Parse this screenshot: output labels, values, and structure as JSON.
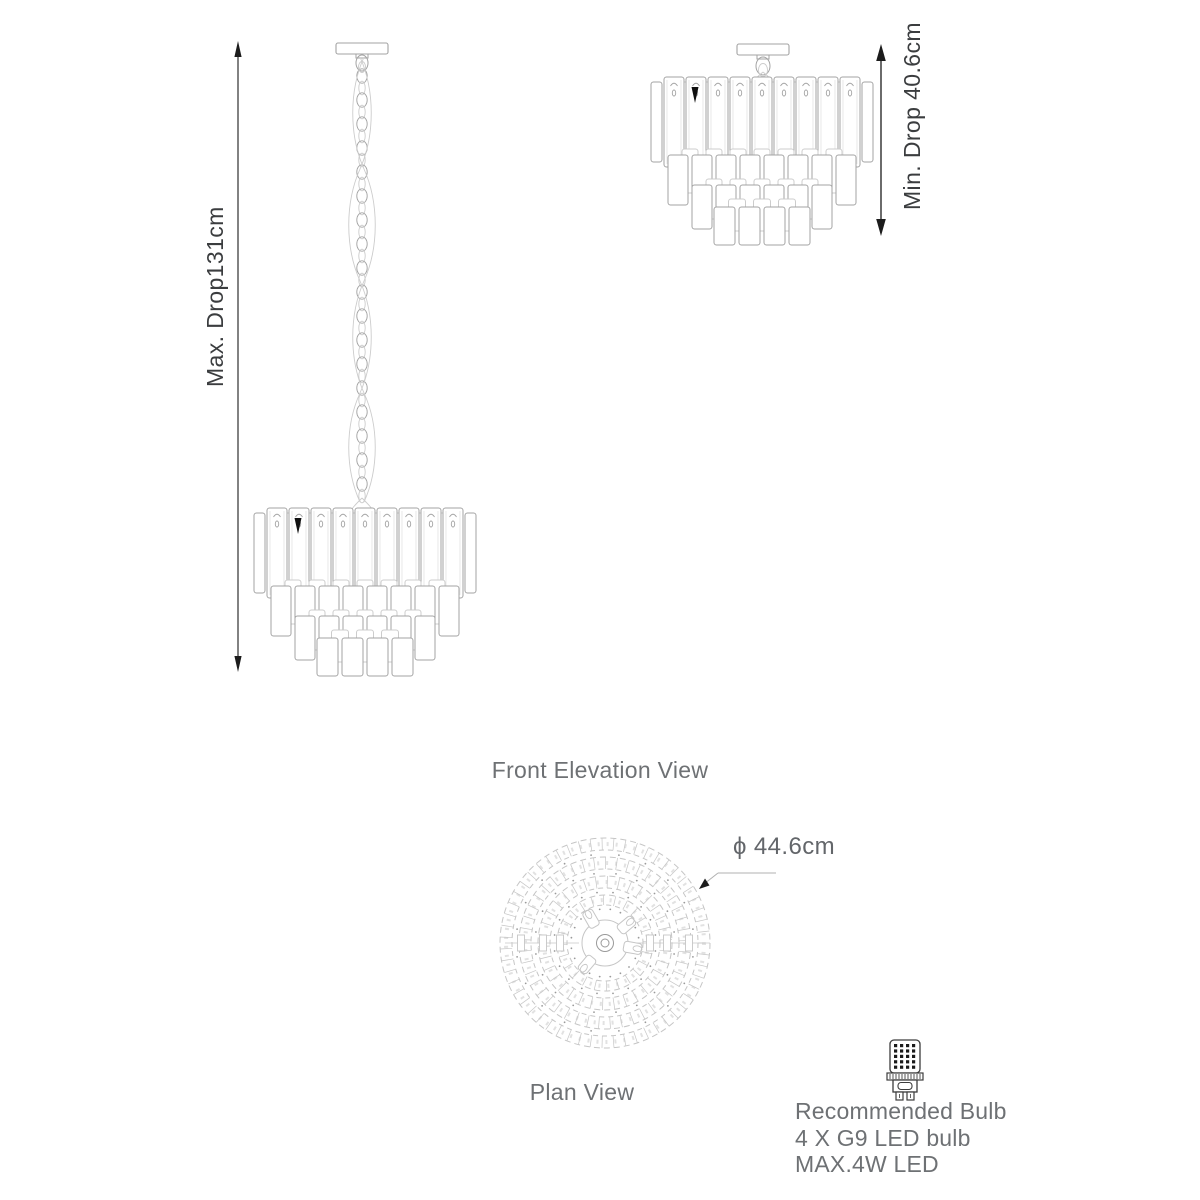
{
  "page": {
    "type": "product-dimension-diagram",
    "background": "#ffffff"
  },
  "colors": {
    "artwork_line": "#a3a3a3",
    "artwork_line_light": "#cccccc",
    "artwork_inner": "#e2e2e2",
    "plan_line": "#c6c6c6",
    "plan_dot": "#9a9a9a",
    "dimension_line": "#1c1c1c",
    "caption_text": "#6e7174",
    "dimension_text": "#3b3d3f",
    "bulb_icon_line": "#3c3c3c"
  },
  "front_elevation": {
    "caption": "Front Elevation View",
    "max_drop_label": "Max. Drop131cm",
    "min_drop_label": "Min. Drop 40.6cm"
  },
  "plan": {
    "caption": "Plan View",
    "diameter_label": "ϕ 44.6cm"
  },
  "bulb_info": {
    "icon": "g9-led-bulb-icon",
    "title": "Recommended Bulb",
    "line2": "4 X G9 LED bulb",
    "line3": "MAX.4W LED"
  }
}
